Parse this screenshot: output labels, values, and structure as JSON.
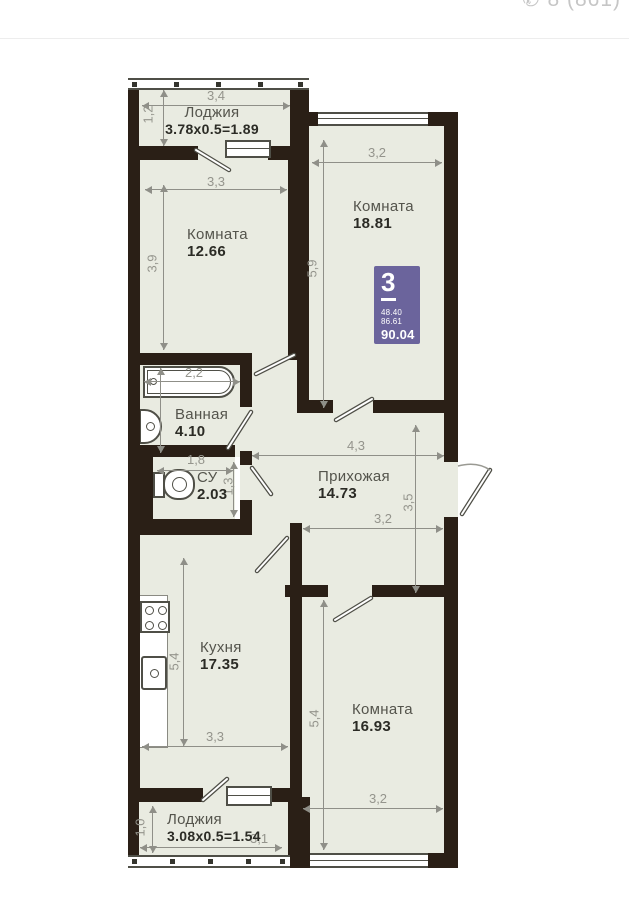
{
  "header": {
    "phone_partial": "8 (861)"
  },
  "badge": {
    "rooms": "3",
    "line1": "48.40",
    "line2": "86.61",
    "total": "90.04",
    "color": "#6b649c"
  },
  "colors": {
    "wall": "#2a1f16",
    "floor": "#e9ebe1",
    "dimension": "#8f8f88"
  },
  "rooms": {
    "loggia_top": {
      "name": "Лоджия",
      "formula": "3.78x0.5=1.89",
      "dims": {
        "w": "3,4",
        "h": "1,2"
      }
    },
    "room_top_left": {
      "name": "Комната",
      "area": "12.66",
      "dims": {
        "w": "3,3",
        "h": "3,9"
      }
    },
    "room_top_right": {
      "name": "Комната",
      "area": "18.81",
      "dims": {
        "w": "3,2",
        "h": "5,9"
      }
    },
    "bathroom": {
      "name": "Ванная",
      "area": "4.10",
      "dims": {
        "w": "2,2"
      }
    },
    "wc": {
      "name": "СУ",
      "area": "2.03",
      "dims": {
        "w": "1,8",
        "h": "1,3"
      }
    },
    "hallway": {
      "name": "Прихожая",
      "area": "14.73",
      "dims": {
        "w_top": "4,3",
        "w_bottom": "3,2",
        "h": "3,5"
      }
    },
    "kitchen": {
      "name": "Кухня",
      "area": "17.35",
      "dims": {
        "w": "3,3",
        "h": "5,4"
      }
    },
    "room_bottom_right": {
      "name": "Комната",
      "area": "16.93",
      "dims": {
        "w": "3,2",
        "h": "5,4"
      }
    },
    "loggia_bottom": {
      "name": "Лоджия",
      "formula": "3.08x0.5=1.54",
      "dims": {
        "w": "3,1",
        "h": "1,0"
      }
    }
  }
}
